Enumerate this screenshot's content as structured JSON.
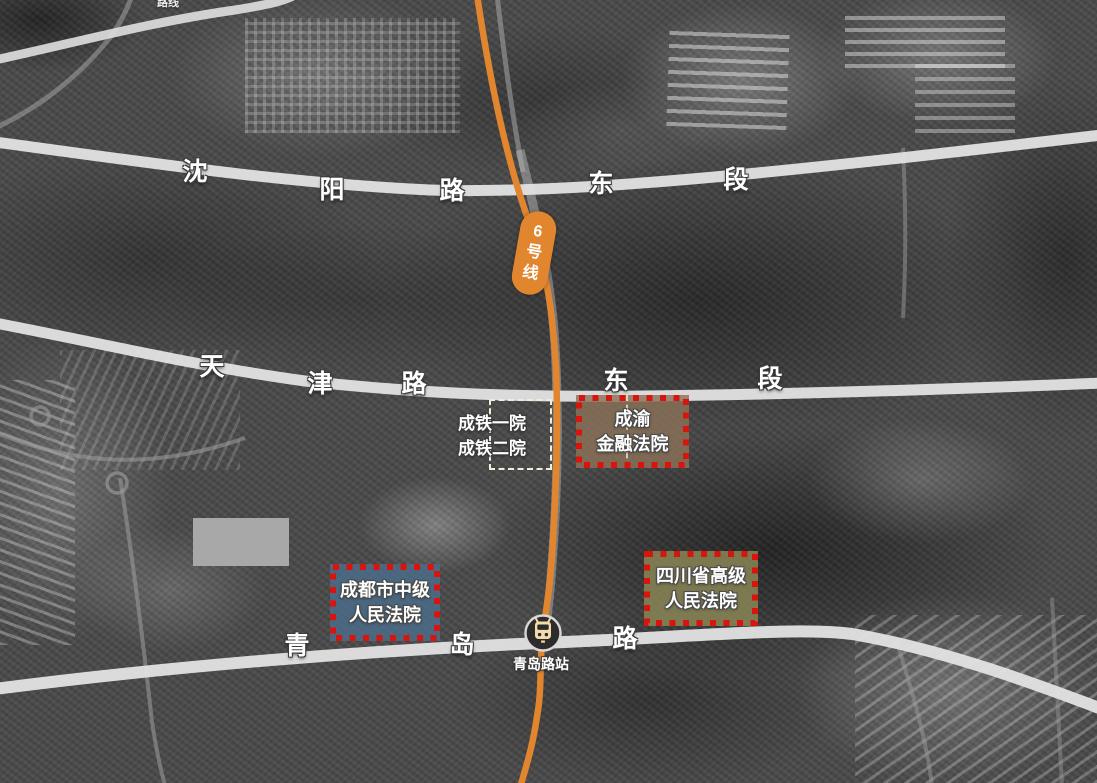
{
  "map_title": "法院区位示意图(卫星图)",
  "top_edge_partial_label": "路线",
  "metro_line": {
    "badge_text": "6号线",
    "badge_chars": [
      "6",
      "号",
      "线"
    ],
    "station_name": "青岛路站"
  },
  "roads": [
    {
      "id": "shenyang",
      "name": "沈阳路东段",
      "chars": [
        "沈",
        "阳",
        "路",
        "东",
        "段"
      ]
    },
    {
      "id": "tianjin",
      "name": "天津路东段",
      "chars": [
        "天",
        "津",
        "路",
        "东",
        "段"
      ]
    },
    {
      "id": "qingdao",
      "name": "青岛路",
      "chars": [
        "青",
        "岛",
        "路"
      ]
    }
  ],
  "sites": {
    "chengtie": {
      "lines": [
        "成铁一院",
        "成铁二院"
      ]
    },
    "chengyu": {
      "lines": [
        "成渝",
        "金融法院"
      ]
    },
    "zhongyuan": {
      "lines": [
        "成都市中级",
        "人民法院"
      ]
    },
    "gaoyuan": {
      "lines": [
        "四川省高级",
        "人民法院"
      ]
    }
  },
  "colors": {
    "metro_line": "#E1862F",
    "highlight_border": "#D8140C",
    "financial_court_fill": "#8A7158",
    "intermediate_court_fill": "#4C6E8C",
    "higher_court_fill": "#8A8556",
    "parcel_outline": "#F2EDDA",
    "road": "#E3E3E3",
    "station_icon_bg": "#2E2C2A",
    "station_icon_train": "#F2DCAE",
    "redaction_box": "#A8A8A8"
  }
}
